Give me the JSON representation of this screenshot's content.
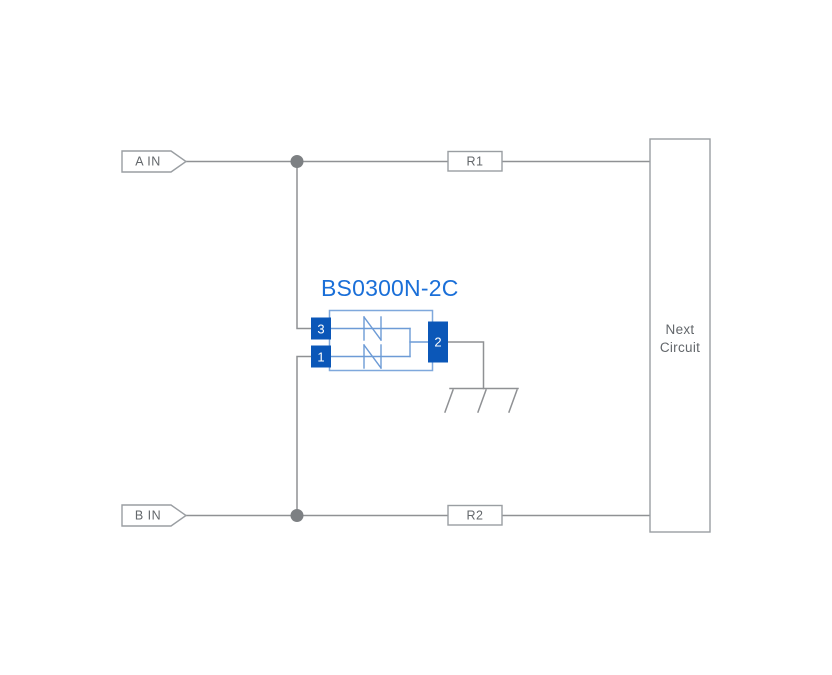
{
  "canvas": {
    "width": 832,
    "height": 675,
    "background": "#ffffff"
  },
  "colors": {
    "wire": "#8f9194",
    "box_border": "#9a9ea2",
    "box_fill": "#ffffff",
    "label_text": "#63676b",
    "junction_dot": "#7d8083",
    "component_blue": "#0b57b8",
    "component_outline": "#7fa8dc",
    "component_inner": "#6d9bd6",
    "title_blue": "#1a6fd8",
    "pin_text": "#ffffff"
  },
  "inputs": {
    "a": {
      "label": "A IN"
    },
    "b": {
      "label": "B IN"
    }
  },
  "resistors": {
    "r1": {
      "label": "R1"
    },
    "r2": {
      "label": "R2"
    }
  },
  "next_circuit": {
    "line1": "Next",
    "line2": "Circuit"
  },
  "component": {
    "title": "BS0300N-2C",
    "pins": {
      "pin3": "3",
      "pin1": "1",
      "pin2": "2"
    }
  }
}
